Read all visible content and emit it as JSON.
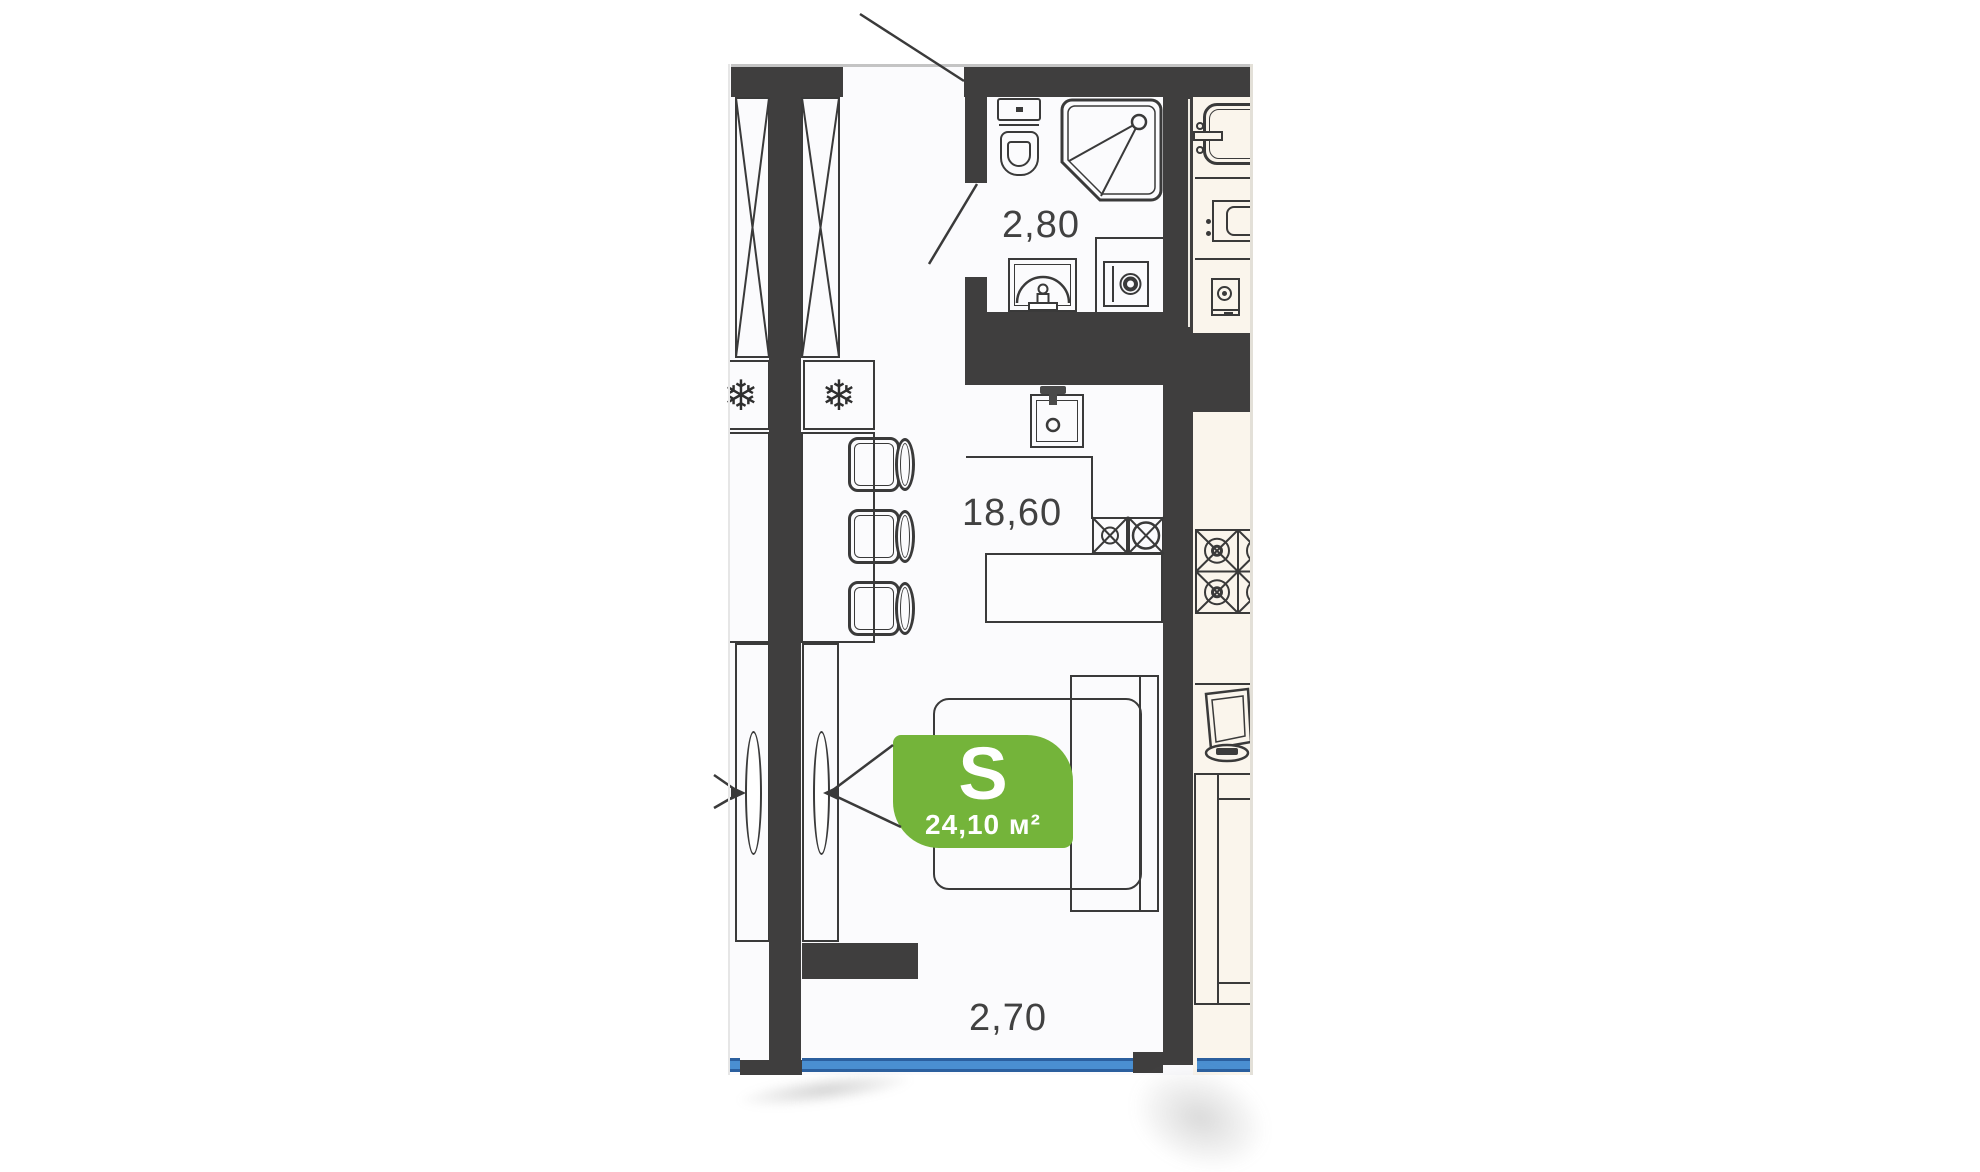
{
  "floorplan": {
    "unit_badge": {
      "letter": "S",
      "area": "24,10 м²"
    },
    "room_labels": {
      "bathroom": "2,80",
      "living_kitchen": "18,60",
      "window_wall": "2,70"
    },
    "glyphs": {
      "snowflake": "❄"
    },
    "colors": {
      "wall_dark": "#3F3E3E",
      "badge_green": "#74B43A",
      "window_blue": "#4A8FD1",
      "neighbor_floor": "#FAF5EC",
      "line_dark": "#3A3A3A"
    }
  }
}
